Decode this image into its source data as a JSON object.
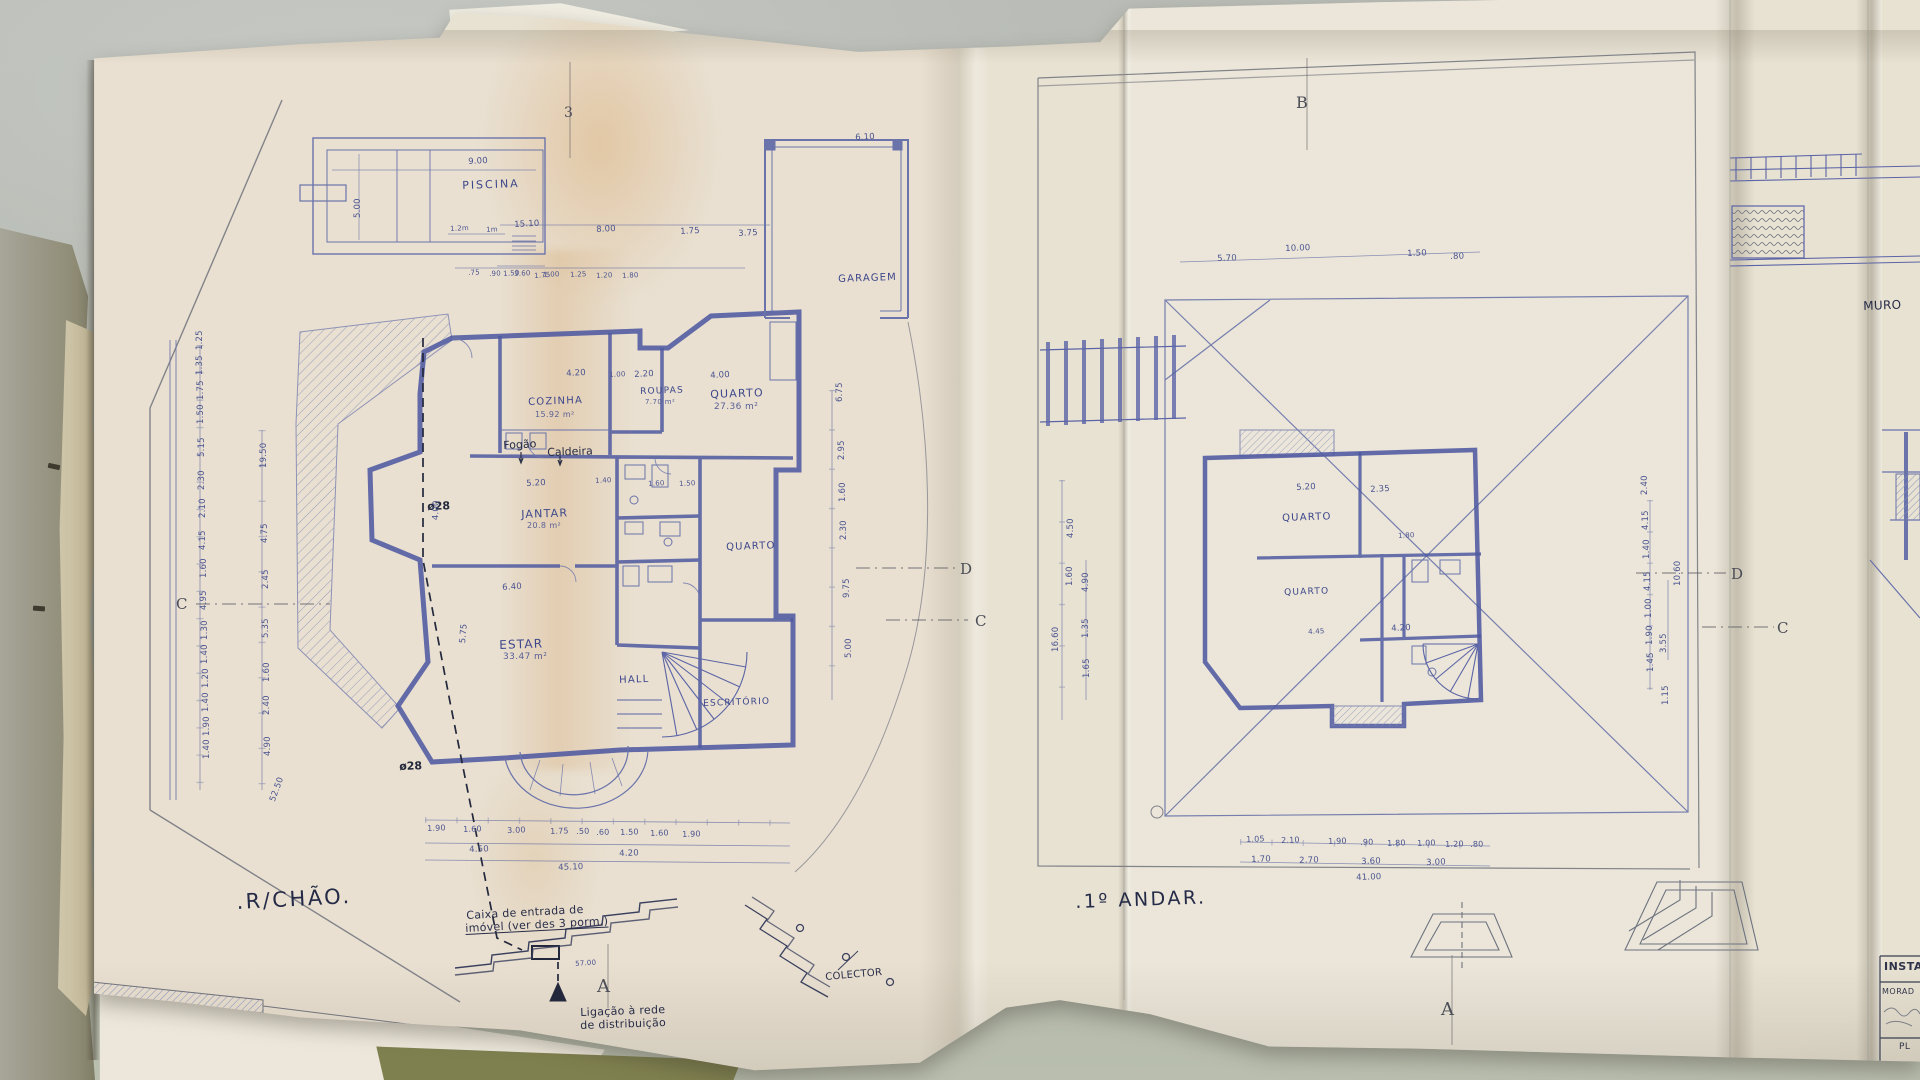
{
  "colors": {
    "paper": "#e8e2d3",
    "ink_wall": "#4f59a0",
    "ink_thin": "#7079ad",
    "ink_dark": "#2c3145",
    "pencil": "#7e7f88",
    "table": "#b6bab2",
    "cover": "#9a9786",
    "under_sheet_olive": "#7f804f"
  },
  "drawing": {
    "language": "Portuguese",
    "left_plan_title": ".R/CHÃO.",
    "right_plan_title": ".1º ANDAR."
  },
  "text_layers": {
    "titles": [
      {
        "t": ".R/CHÃO.",
        "x": 236,
        "y": 892,
        "s": 21,
        "r": -3
      },
      {
        "t": ".1º ANDAR.",
        "x": 1075,
        "y": 893,
        "s": 19,
        "r": -2
      }
    ],
    "room_labels": [
      {
        "t": "PISCINA",
        "x": 462,
        "y": 180,
        "s": 11,
        "ls": 2,
        "r": -2
      },
      {
        "t": "GARAGEM",
        "x": 838,
        "y": 275,
        "s": 10,
        "r": -2
      },
      {
        "t": "COZINHA",
        "x": 528,
        "y": 398,
        "s": 10,
        "r": -2
      },
      {
        "t": "ROUPAS",
        "x": 640,
        "y": 388,
        "s": 9,
        "r": -2
      },
      {
        "t": "QUARTO",
        "x": 710,
        "y": 389,
        "s": 11,
        "r": -2
      },
      {
        "t": "JANTAR",
        "x": 521,
        "y": 509,
        "s": 11,
        "r": -2
      },
      {
        "t": "ESTAR",
        "x": 499,
        "y": 639,
        "s": 12,
        "r": -2
      },
      {
        "t": "HALL",
        "x": 619,
        "y": 676,
        "s": 10,
        "r": -2
      },
      {
        "t": "QUARTO",
        "x": 726,
        "y": 543,
        "s": 10,
        "r": -2
      },
      {
        "t": "ESCRITÓRIO",
        "x": 703,
        "y": 700,
        "s": 9,
        "r": -2
      },
      {
        "t": "QUARTO",
        "x": 1282,
        "y": 514,
        "s": 10,
        "r": -2
      },
      {
        "t": "QUARTO",
        "x": 1284,
        "y": 589,
        "s": 9,
        "r": -2
      }
    ],
    "area_labels": [
      {
        "t": "15.92 m²",
        "x": 535,
        "y": 411
      },
      {
        "t": "7.70 m²",
        "x": 645,
        "y": 399,
        "s": 7
      },
      {
        "t": "27.36 m²",
        "x": 714,
        "y": 403,
        "s": 9
      },
      {
        "t": "20.8 m²",
        "x": 527,
        "y": 522
      },
      {
        "t": "33.47 m²",
        "x": 503,
        "y": 653,
        "s": 9
      }
    ],
    "equipment_labels": [
      {
        "t": "Fogão",
        "x": 503,
        "y": 440,
        "r": -3
      },
      {
        "t": "Caldeira",
        "x": 547,
        "y": 447,
        "r": -2
      }
    ],
    "pipe_labels": [
      {
        "t": "ø28",
        "x": 427,
        "y": 501,
        "r": -2
      },
      {
        "t": "ø28",
        "x": 399,
        "y": 761,
        "r": -2
      }
    ],
    "notes": [
      {
        "t": "Caixa de entrada de",
        "x": 466,
        "y": 910,
        "r": -3
      },
      {
        "t": "imóvel (ver des 3 porm.)",
        "x": 465,
        "y": 923,
        "r": -3,
        "c": "u"
      },
      {
        "t": "Ligação à rede",
        "x": 580,
        "y": 1007,
        "r": -2
      },
      {
        "t": "de distribuição",
        "x": 580,
        "y": 1020,
        "r": -2
      },
      {
        "t": "COLECTOR",
        "x": 825,
        "y": 973,
        "s": 10,
        "r": -5
      },
      {
        "t": "MURO",
        "x": 1863,
        "y": 300,
        "s": 12,
        "r": -2
      }
    ],
    "section_markers": [
      {
        "t": "3",
        "x": 564,
        "y": 106,
        "s": 14
      },
      {
        "t": "B",
        "x": 1296,
        "y": 95,
        "s": 16
      },
      {
        "t": "C",
        "x": 176,
        "y": 597
      },
      {
        "t": "D",
        "x": 960,
        "y": 562
      },
      {
        "t": "C",
        "x": 975,
        "y": 614
      },
      {
        "t": "D",
        "x": 1731,
        "y": 567
      },
      {
        "t": "C",
        "x": 1777,
        "y": 621
      },
      {
        "t": "A",
        "x": 597,
        "y": 978,
        "s": 18
      },
      {
        "t": "A",
        "x": 1441,
        "y": 1001,
        "s": 18
      }
    ],
    "dims_left": [
      {
        "t": "9.00",
        "x": 468,
        "y": 158,
        "r": -3
      },
      {
        "t": "5.00",
        "x": 354,
        "y": 218,
        "r": -90
      },
      {
        "t": "1.2m",
        "x": 450,
        "y": 226,
        "s": 7,
        "r": -3
      },
      {
        "t": "1m",
        "x": 486,
        "y": 227,
        "s": 7,
        "r": -3
      },
      {
        "t": "1.50",
        "x": 503,
        "y": 271,
        "s": 7,
        "r": -4
      },
      {
        "t": "1.75",
        "x": 534,
        "y": 273,
        "s": 7,
        "r": -4
      },
      {
        "t": "15.10",
        "x": 514,
        "y": 221,
        "r": -3
      },
      {
        "t": "8.00",
        "x": 596,
        "y": 226,
        "r": -3
      },
      {
        "t": "1.75",
        "x": 680,
        "y": 228,
        "r": -3
      },
      {
        "t": "3.75",
        "x": 738,
        "y": 230,
        "r": -3
      },
      {
        "t": "6.10",
        "x": 855,
        "y": 134,
        "r": -3
      },
      {
        "t": ".75",
        "x": 468,
        "y": 270,
        "s": 7,
        "r": -3
      },
      {
        "t": ".90",
        "x": 489,
        "y": 271,
        "s": 7,
        "r": -3
      },
      {
        "t": "3.60",
        "x": 514,
        "y": 271,
        "s": 7,
        "r": -3
      },
      {
        "t": "1.00",
        "x": 543,
        "y": 272,
        "s": 7,
        "r": -3
      },
      {
        "t": "1.25",
        "x": 570,
        "y": 272,
        "s": 7,
        "r": -3
      },
      {
        "t": "1.20",
        "x": 596,
        "y": 273,
        "s": 7,
        "r": -3
      },
      {
        "t": "1.80",
        "x": 622,
        "y": 273,
        "s": 7,
        "r": -3
      },
      {
        "t": "4.20",
        "x": 566,
        "y": 370,
        "r": -3
      },
      {
        "t": "1.00",
        "x": 609,
        "y": 372,
        "s": 7,
        "r": -3
      },
      {
        "t": "2.20",
        "x": 634,
        "y": 371,
        "r": -3
      },
      {
        "t": "4.00",
        "x": 710,
        "y": 372,
        "r": -3
      },
      {
        "t": "5.20",
        "x": 526,
        "y": 480,
        "r": -3
      },
      {
        "t": "1.40",
        "x": 595,
        "y": 478,
        "s": 7,
        "r": -3
      },
      {
        "t": "1.60",
        "x": 648,
        "y": 481,
        "s": 7,
        "r": -3
      },
      {
        "t": "1.50",
        "x": 679,
        "y": 481,
        "s": 7,
        "r": -3
      },
      {
        "t": "6.40",
        "x": 502,
        "y": 584,
        "r": -4
      },
      {
        "t": "4.00",
        "x": 432,
        "y": 520,
        "r": -88
      },
      {
        "t": "5.75",
        "x": 459,
        "y": 643,
        "r": -85
      },
      {
        "t": "1.25",
        "x": 196,
        "y": 350,
        "r": -90
      },
      {
        "t": "1.35",
        "x": 196,
        "y": 375,
        "r": -90
      },
      {
        "t": "1.75",
        "x": 197,
        "y": 400,
        "r": -90
      },
      {
        "t": "1.50",
        "x": 197,
        "y": 424,
        "r": -90
      },
      {
        "t": "5.15",
        "x": 198,
        "y": 457,
        "r": -90
      },
      {
        "t": "2.30",
        "x": 198,
        "y": 490,
        "r": -90
      },
      {
        "t": "2.10",
        "x": 199,
        "y": 518,
        "r": -90
      },
      {
        "t": "4.15",
        "x": 199,
        "y": 550,
        "r": -90
      },
      {
        "t": "1.60",
        "x": 200,
        "y": 578,
        "r": -90
      },
      {
        "t": "4.95",
        "x": 200,
        "y": 610,
        "r": -90
      },
      {
        "t": "1.30",
        "x": 201,
        "y": 640,
        "r": -90
      },
      {
        "t": "1.40",
        "x": 201,
        "y": 664,
        "r": -90
      },
      {
        "t": "1.20",
        "x": 202,
        "y": 688,
        "r": -90
      },
      {
        "t": "1.40",
        "x": 202,
        "y": 712,
        "r": -90
      },
      {
        "t": "1.90",
        "x": 203,
        "y": 736,
        "r": -90
      },
      {
        "t": "1.40",
        "x": 203,
        "y": 759,
        "r": -90
      },
      {
        "t": "19.50",
        "x": 260,
        "y": 468,
        "r": -90
      },
      {
        "t": "4.75",
        "x": 261,
        "y": 543,
        "r": -90
      },
      {
        "t": "2.45",
        "x": 262,
        "y": 589,
        "r": -90
      },
      {
        "t": "5.35",
        "x": 262,
        "y": 638,
        "r": -90
      },
      {
        "t": "1.60",
        "x": 263,
        "y": 682,
        "r": -90
      },
      {
        "t": "2.40",
        "x": 263,
        "y": 715,
        "r": -90
      },
      {
        "t": "4.90",
        "x": 264,
        "y": 756,
        "r": -90
      },
      {
        "t": "52.50",
        "x": 269,
        "y": 800,
        "r": -70
      },
      {
        "t": "6.75",
        "x": 836,
        "y": 402,
        "r": -90
      },
      {
        "t": "2.95",
        "x": 838,
        "y": 460,
        "r": -90
      },
      {
        "t": "1.60",
        "x": 839,
        "y": 502,
        "r": -90
      },
      {
        "t": "2.30",
        "x": 840,
        "y": 540,
        "r": -90
      },
      {
        "t": "9.75",
        "x": 843,
        "y": 598,
        "r": -90
      },
      {
        "t": "5.00",
        "x": 845,
        "y": 658,
        "r": -90
      },
      {
        "t": "1.90",
        "x": 427,
        "y": 825,
        "s": 8,
        "r": -2
      },
      {
        "t": "1.60",
        "x": 463,
        "y": 826,
        "s": 8,
        "r": -2
      },
      {
        "t": "3.00",
        "x": 507,
        "y": 827,
        "s": 8,
        "r": -2
      },
      {
        "t": "1.75",
        "x": 550,
        "y": 828,
        "s": 8,
        "r": -2
      },
      {
        "t": ".50",
        "x": 576,
        "y": 828,
        "s": 8,
        "r": -2
      },
      {
        "t": ".60",
        "x": 596,
        "y": 829,
        "s": 8,
        "r": -2
      },
      {
        "t": "1.50",
        "x": 620,
        "y": 829,
        "s": 8,
        "r": -2
      },
      {
        "t": "1.60",
        "x": 650,
        "y": 830,
        "s": 8,
        "r": -2
      },
      {
        "t": "1.90",
        "x": 682,
        "y": 831,
        "s": 8,
        "r": -2
      },
      {
        "t": "4.50",
        "x": 469,
        "y": 846,
        "r": -2
      },
      {
        "t": "4.20",
        "x": 619,
        "y": 850,
        "r": -2
      },
      {
        "t": "45.10",
        "x": 558,
        "y": 864,
        "r": -2
      },
      {
        "t": "57.00",
        "x": 575,
        "y": 961,
        "s": 7,
        "r": -4
      },
      {
        "t": "19.20",
        "x": 146,
        "y": 1012,
        "s": 7,
        "r": 3
      }
    ],
    "dims_right": [
      {
        "t": "5.70",
        "x": 1217,
        "y": 255,
        "r": -2
      },
      {
        "t": "10.00",
        "x": 1285,
        "y": 245,
        "r": -2
      },
      {
        "t": "1.50",
        "x": 1407,
        "y": 250,
        "r": -2
      },
      {
        "t": ".80",
        "x": 1450,
        "y": 253,
        "r": -2
      },
      {
        "t": "4.50",
        "x": 1067,
        "y": 538,
        "r": -90
      },
      {
        "t": "1.60",
        "x": 1066,
        "y": 586,
        "r": -90
      },
      {
        "t": "4.90",
        "x": 1082,
        "y": 592,
        "r": -90
      },
      {
        "t": "1.35",
        "x": 1082,
        "y": 638,
        "r": -90
      },
      {
        "t": "1.65",
        "x": 1083,
        "y": 678,
        "r": -90
      },
      {
        "t": "16.60",
        "x": 1052,
        "y": 652,
        "r": -90
      },
      {
        "t": "5.20",
        "x": 1296,
        "y": 484,
        "r": -3
      },
      {
        "t": "2.35",
        "x": 1370,
        "y": 486,
        "r": -3
      },
      {
        "t": "1.80",
        "x": 1398,
        "y": 533,
        "s": 7,
        "r": -3
      },
      {
        "t": "4.45",
        "x": 1308,
        "y": 629,
        "s": 7,
        "r": -3
      },
      {
        "t": "4.20",
        "x": 1391,
        "y": 625,
        "r": -3
      },
      {
        "t": "1.05",
        "x": 1246,
        "y": 836,
        "s": 8,
        "r": -2
      },
      {
        "t": "2.10",
        "x": 1281,
        "y": 837,
        "s": 8,
        "r": -2
      },
      {
        "t": "1.90",
        "x": 1328,
        "y": 838,
        "s": 8,
        "r": -2
      },
      {
        "t": ".90",
        "x": 1360,
        "y": 839,
        "s": 8,
        "r": -2
      },
      {
        "t": "1.80",
        "x": 1387,
        "y": 840,
        "s": 8,
        "r": -2
      },
      {
        "t": "1.00",
        "x": 1417,
        "y": 840,
        "s": 8,
        "r": -2
      },
      {
        "t": "1.20",
        "x": 1445,
        "y": 841,
        "s": 8,
        "r": -2
      },
      {
        "t": ".80",
        "x": 1470,
        "y": 841,
        "s": 8,
        "r": -2
      },
      {
        "t": "1.70",
        "x": 1251,
        "y": 856,
        "r": -2
      },
      {
        "t": "2.70",
        "x": 1299,
        "y": 857,
        "r": -2
      },
      {
        "t": "3.60",
        "x": 1361,
        "y": 858,
        "r": -2
      },
      {
        "t": "3.00",
        "x": 1426,
        "y": 859,
        "r": -2
      },
      {
        "t": "41.00",
        "x": 1356,
        "y": 874,
        "r": -2
      },
      {
        "t": "2.40",
        "x": 1641,
        "y": 495,
        "r": -90
      },
      {
        "t": "4.15",
        "x": 1642,
        "y": 530,
        "r": -90
      },
      {
        "t": "1.40",
        "x": 1643,
        "y": 559,
        "r": -90
      },
      {
        "t": "4.15",
        "x": 1644,
        "y": 591,
        "r": -90
      },
      {
        "t": "1.00",
        "x": 1645,
        "y": 618,
        "r": -90
      },
      {
        "t": "1.90",
        "x": 1646,
        "y": 645,
        "r": -90
      },
      {
        "t": "1.45",
        "x": 1647,
        "y": 672,
        "r": -90
      },
      {
        "t": "10.60",
        "x": 1674,
        "y": 586,
        "r": -90
      },
      {
        "t": "3.55",
        "x": 1660,
        "y": 653,
        "r": -90
      },
      {
        "t": "1.15",
        "x": 1662,
        "y": 705,
        "r": -90
      }
    ],
    "titleblock": [
      {
        "t": "INSTAL",
        "x": 1884,
        "y": 961,
        "s": 11,
        "c": "b"
      },
      {
        "t": "MORAD",
        "x": 1882,
        "y": 988,
        "s": 8
      },
      {
        "t": "PL",
        "x": 1899,
        "y": 1043,
        "s": 9
      }
    ]
  }
}
